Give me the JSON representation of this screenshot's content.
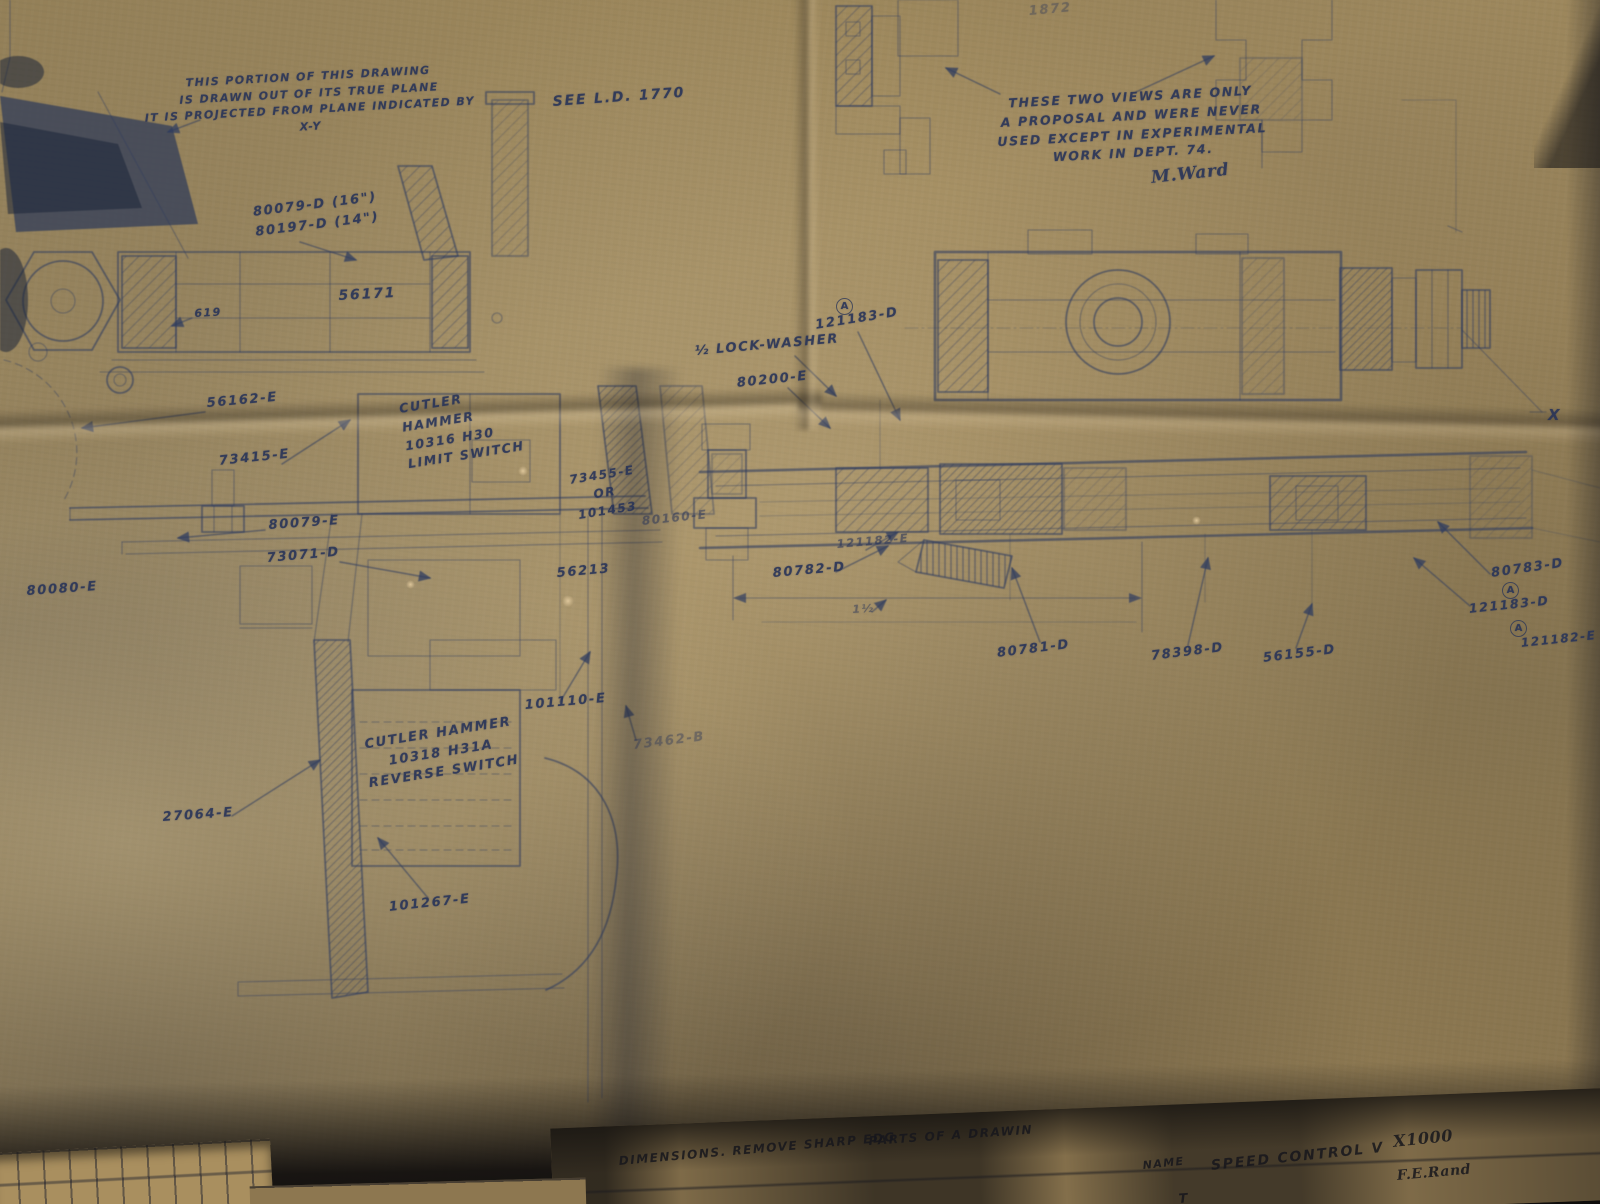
{
  "colors": {
    "paper": "#a8905f",
    "ink": "#2f3c5f",
    "shadow": "#141210"
  },
  "annotations": [
    {
      "name": "note-out-of-plane",
      "text": "THIS PORTION OF THIS DRAWING\nIS DRAWN OUT OF ITS TRUE PLANE\nIT IS PROJECTED FROM PLANE INDICATED BY X-Y",
      "x": 138,
      "y": 78,
      "size": 11,
      "rot": -3,
      "cls": "center",
      "w": 340
    },
    {
      "name": "ref-see-ld-1770",
      "text": "SEE L.D. 1770",
      "x": 552,
      "y": 92,
      "size": 14,
      "rot": -4
    },
    {
      "name": "label-80079d-80197d",
      "text": "80079-D (16\")\n80197-D (14\")",
      "x": 252,
      "y": 203,
      "size": 13,
      "rot": -7
    },
    {
      "name": "label-56171",
      "text": "56171",
      "x": 338,
      "y": 286,
      "size": 14,
      "rot": -3
    },
    {
      "name": "label-619",
      "text": "619",
      "x": 194,
      "y": 306,
      "size": 11,
      "rot": -3
    },
    {
      "name": "note-proposal",
      "text": "THESE TWO VIEWS ARE ONLY\nA PROPOSAL AND WERE NEVER\nUSED EXCEPT IN EXPERIMENTAL\nWORK IN DEPT. 74.",
      "x": 980,
      "y": 96,
      "size": 12.5,
      "rot": -3,
      "cls": "center",
      "w": 300
    },
    {
      "name": "signature-ward",
      "text": "M.Ward",
      "x": 1150,
      "y": 166,
      "size": 17,
      "rot": -6,
      "cls": "script"
    },
    {
      "name": "scribble-top",
      "text": "1872",
      "x": 1028,
      "y": 2,
      "size": 13,
      "rot": -5,
      "op": 0.4
    },
    {
      "name": "circle-a-upper",
      "text": "A",
      "x": 836,
      "y": 298,
      "size": 10,
      "rot": 0,
      "cls": "circ"
    },
    {
      "name": "label-121183d-upper",
      "text": "121183-D",
      "x": 814,
      "y": 316,
      "size": 13,
      "rot": -9
    },
    {
      "name": "label-lock-washer",
      "text": "½ LOCK-WASHER",
      "x": 694,
      "y": 342,
      "size": 13,
      "rot": -5
    },
    {
      "name": "label-80200e",
      "text": "80200-E",
      "x": 736,
      "y": 374,
      "size": 13,
      "rot": -6
    },
    {
      "name": "label-56162e",
      "text": "56162-E",
      "x": 206,
      "y": 394,
      "size": 13,
      "rot": -5
    },
    {
      "name": "label-73415e",
      "text": "73415-E",
      "x": 218,
      "y": 452,
      "size": 13,
      "rot": -6
    },
    {
      "name": "note-cutler-limit",
      "text": "CUTLER\n  HAMMER\n  10316 H30\nLIMIT SWITCH",
      "x": 398,
      "y": 400,
      "size": 12.5,
      "rot": -9
    },
    {
      "name": "label-73455e",
      "text": "73455-E\nOR\n101453",
      "x": 562,
      "y": 472,
      "size": 12,
      "rot": -9,
      "cls": "center",
      "w": 78
    },
    {
      "name": "label-80079e",
      "text": "80079-E",
      "x": 268,
      "y": 516,
      "size": 13,
      "rot": -4
    },
    {
      "name": "label-73071d",
      "text": "73071-D",
      "x": 266,
      "y": 549,
      "size": 13,
      "rot": -5
    },
    {
      "name": "label-80080e",
      "text": "80080-E",
      "x": 26,
      "y": 582,
      "size": 13,
      "rot": -4
    },
    {
      "name": "label-56213",
      "text": "56213",
      "x": 556,
      "y": 564,
      "size": 13,
      "rot": -5
    },
    {
      "name": "label-80160e",
      "text": "80160-E",
      "x": 641,
      "y": 512,
      "size": 12,
      "rot": -6,
      "op": 0.6
    },
    {
      "name": "label-121182e-mid",
      "text": "121182-E",
      "x": 836,
      "y": 536,
      "size": 11.5,
      "rot": -5,
      "op": 0.65
    },
    {
      "name": "label-80782d",
      "text": "80782-D",
      "x": 772,
      "y": 564,
      "size": 13,
      "rot": -5
    },
    {
      "name": "label-101110e",
      "text": "101110-E",
      "x": 524,
      "y": 696,
      "size": 13,
      "rot": -5
    },
    {
      "name": "label-73462b",
      "text": "73462-B",
      "x": 632,
      "y": 736,
      "size": 13,
      "rot": -7,
      "op": 0.45
    },
    {
      "name": "note-cutler-reverse",
      "text": "CUTLER HAMMER\n10318 H31A\nREVERSE SWITCH",
      "x": 360,
      "y": 736,
      "size": 13,
      "rot": -9,
      "cls": "center",
      "w": 155
    },
    {
      "name": "label-27064e",
      "text": "27064-E",
      "x": 162,
      "y": 808,
      "size": 13,
      "rot": -4
    },
    {
      "name": "label-101267e",
      "text": "101267-E",
      "x": 388,
      "y": 898,
      "size": 13,
      "rot": -6
    },
    {
      "name": "label-80781d",
      "text": "80781-D",
      "x": 996,
      "y": 644,
      "size": 13,
      "rot": -7
    },
    {
      "name": "label-78398d",
      "text": "78398-D",
      "x": 1150,
      "y": 647,
      "size": 13,
      "rot": -7
    },
    {
      "name": "label-56155d",
      "text": "56155-D",
      "x": 1262,
      "y": 649,
      "size": 13,
      "rot": -7
    },
    {
      "name": "label-80783d",
      "text": "80783-D",
      "x": 1490,
      "y": 564,
      "size": 13,
      "rot": -8
    },
    {
      "name": "circle-a-right-1",
      "text": "A",
      "x": 1502,
      "y": 582,
      "size": 10,
      "rot": 0,
      "cls": "circ"
    },
    {
      "name": "label-121183d-right",
      "text": "121183-D",
      "x": 1468,
      "y": 600,
      "size": 12.5,
      "rot": -6
    },
    {
      "name": "circle-a-right-2",
      "text": "A",
      "x": 1510,
      "y": 620,
      "size": 10,
      "rot": 0,
      "cls": "circ"
    },
    {
      "name": "label-121182e-right",
      "text": "121182-E",
      "x": 1520,
      "y": 634,
      "size": 12,
      "rot": -6
    },
    {
      "name": "mark-x",
      "text": "X",
      "x": 1548,
      "y": 404,
      "size": 15,
      "rot": 0
    },
    {
      "name": "dim-half",
      "text": "1½",
      "x": 852,
      "y": 602,
      "size": 11,
      "rot": -3,
      "op": 0.55
    },
    {
      "name": "frag-parts-of-drawing",
      "text": "PARTS OF A DRAWIN",
      "x": 868,
      "y": 1132,
      "size": 12,
      "rot": -4,
      "cls": "sheet-text"
    },
    {
      "name": "frag-remove-sharp-edges",
      "text": "DIMENSIONS.  REMOVE SHARP EDG",
      "x": 618,
      "y": 1152,
      "size": 12,
      "rot": -5,
      "cls": "sheet-text"
    },
    {
      "name": "frag-x1000",
      "text": "X1000",
      "x": 1392,
      "y": 1130,
      "size": 16,
      "rot": -6,
      "cls": "sheet-text script"
    },
    {
      "name": "frag-rand",
      "text": "F.E.Rand",
      "x": 1396,
      "y": 1166,
      "size": 14,
      "rot": -5,
      "cls": "sheet-text script"
    },
    {
      "name": "frag-name",
      "text": "NAME",
      "x": 1142,
      "y": 1158,
      "size": 11,
      "rot": -6,
      "cls": "sheet-text"
    },
    {
      "name": "frag-speed-control",
      "text": "SPEED CONTROL V",
      "x": 1210,
      "y": 1156,
      "size": 14,
      "rot": -6,
      "cls": "sheet-text"
    },
    {
      "name": "frag-t",
      "text": "T",
      "x": 1178,
      "y": 1190,
      "size": 13,
      "rot": -4,
      "cls": "sheet-text"
    }
  ]
}
